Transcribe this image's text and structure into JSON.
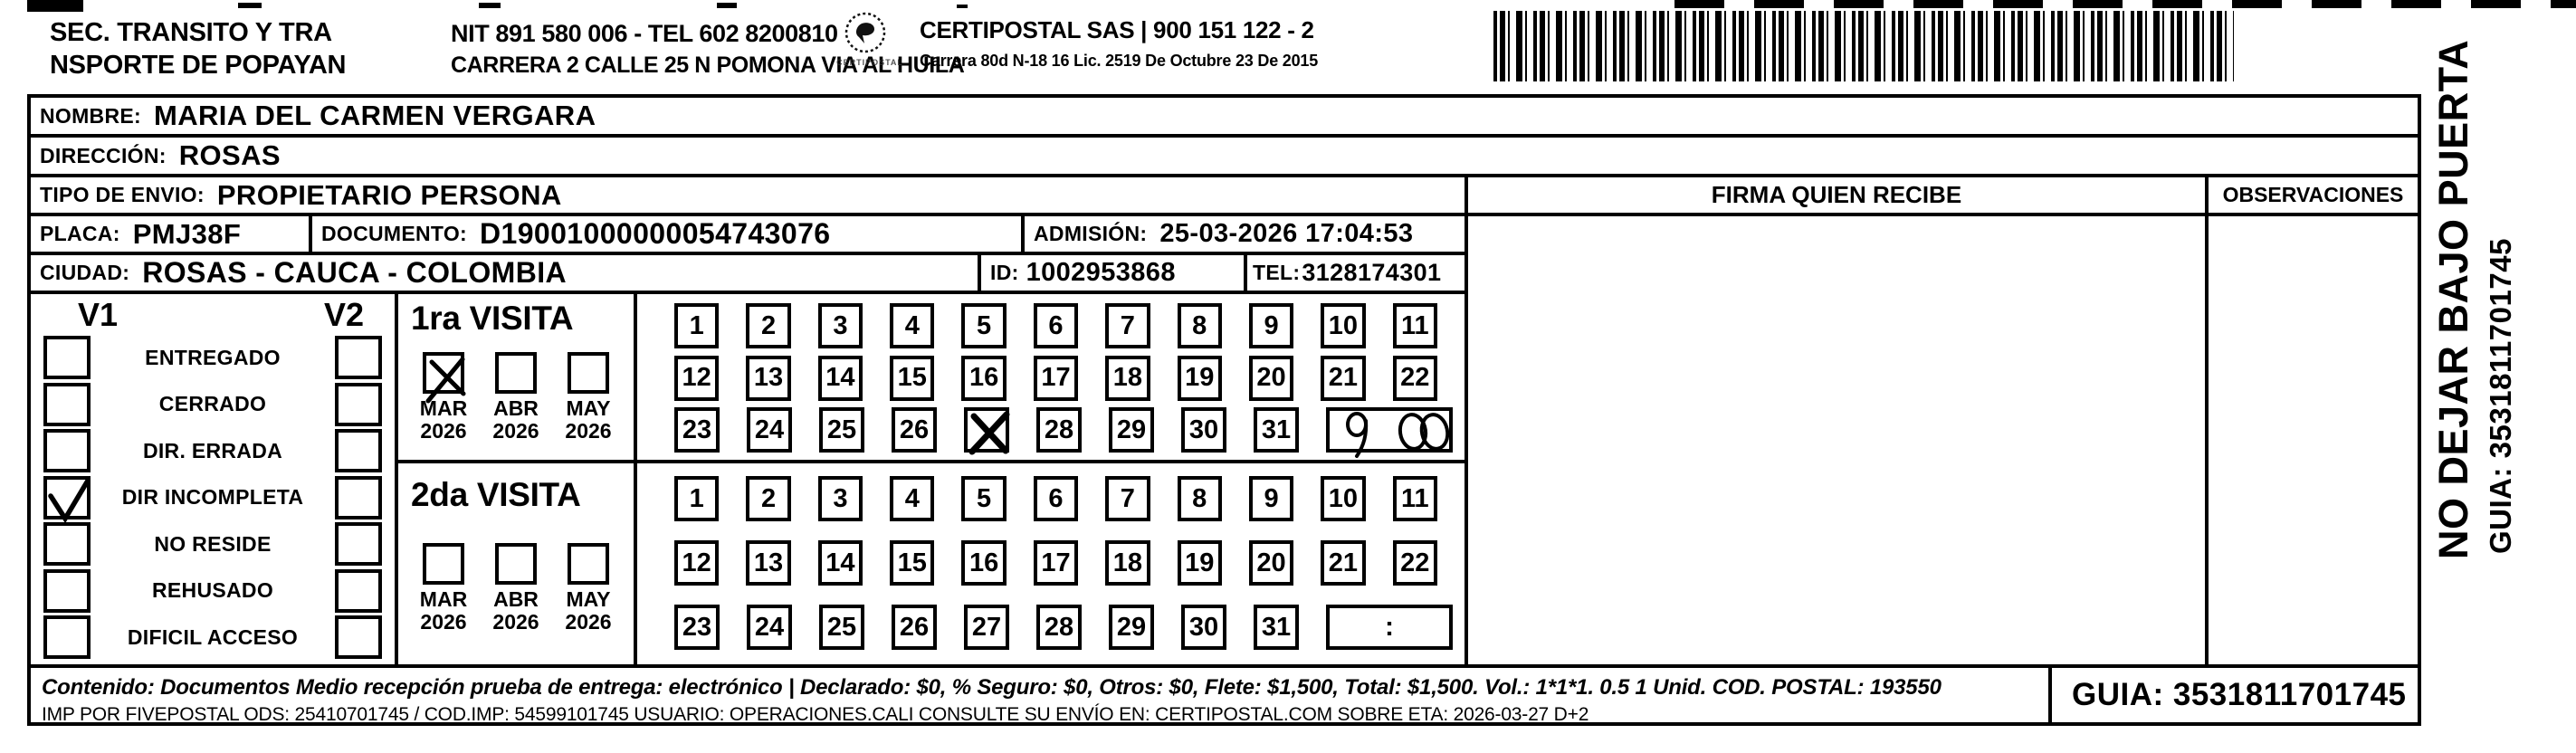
{
  "header": {
    "org_line1": "SEC. TRANSITO Y TRA",
    "org_line2": "NSPORTE DE POPAYAN",
    "nit_line": "NIT 891 580 006 - TEL 602 8200810",
    "address_line": "CARRERA 2 CALLE 25 N POMONA VIA AL HUILA",
    "logo_caption": "CERTIPOSTAL",
    "company_line": "CERTIPOSTAL SAS | 900 151 122 - 2",
    "company_address": "Carrera 80d N-18 16  Lic. 2519 De Octubre 23 De 2015"
  },
  "fields": {
    "nombre_label": "NOMBRE:",
    "nombre": "MARIA DEL CARMEN VERGARA",
    "direccion_label": "DIRECCIÓN:",
    "direccion": "ROSAS",
    "tipo_label": "TIPO DE ENVIO:",
    "tipo": "PROPIETARIO PERSONA",
    "placa_label": "PLACA:",
    "placa": "PMJ38F",
    "documento_label": "DOCUMENTO:",
    "documento": "D19001000000054743076",
    "admision_label": "ADMISIÓN:",
    "admision": "25-03-2026 17:04:53",
    "ciudad_label": "CIUDAD:",
    "ciudad": "ROSAS - CAUCA - COLOMBIA",
    "id_label": "ID:",
    "id": "1002953868",
    "tel_label": "TEL:",
    "tel": "3128174301"
  },
  "status_panel": {
    "col1": "V1",
    "col2": "V2",
    "items": [
      {
        "label": "ENTREGADO",
        "v1": false,
        "v2": false
      },
      {
        "label": "CERRADO",
        "v1": false,
        "v2": false
      },
      {
        "label": "DIR. ERRADA",
        "v1": false,
        "v2": false
      },
      {
        "label": "DIR INCOMPLETA",
        "v1": true,
        "v2": false
      },
      {
        "label": "NO RESIDE",
        "v1": false,
        "v2": false
      },
      {
        "label": "REHUSADO",
        "v1": false,
        "v2": false
      },
      {
        "label": "DIFICIL ACCESO",
        "v1": false,
        "v2": false
      }
    ]
  },
  "visits": {
    "first": {
      "title": "1ra VISITA",
      "months": [
        {
          "month": "MAR",
          "year": "2026",
          "checked": true
        },
        {
          "month": "ABR",
          "year": "2026",
          "checked": false
        },
        {
          "month": "MAY",
          "year": "2026",
          "checked": false
        }
      ],
      "marked_day": 27,
      "time_written": "9:00"
    },
    "second": {
      "title": "2da VISITA",
      "months": [
        {
          "month": "MAR",
          "year": "2026",
          "checked": false
        },
        {
          "month": "ABR",
          "year": "2026",
          "checked": false
        },
        {
          "month": "MAY",
          "year": "2026",
          "checked": false
        }
      ],
      "marked_day": null,
      "time_placeholder": ":"
    }
  },
  "calendar": {
    "days": [
      1,
      2,
      3,
      4,
      5,
      6,
      7,
      8,
      9,
      10,
      11,
      12,
      13,
      14,
      15,
      16,
      17,
      18,
      19,
      20,
      21,
      22,
      23,
      24,
      25,
      26,
      27,
      28,
      29,
      30,
      31
    ]
  },
  "firma_header": "FIRMA QUIEN RECIBE",
  "observaciones_header": "OBSERVACIONES",
  "side": {
    "warning": "NO DEJAR BAJO PUERTA",
    "guia": "GUIA: 3531811701745"
  },
  "footer": {
    "line1": "Contenido: Documentos Medio recepción prueba de entrega: electrónico | Declarado: $0, % Seguro: $0, Otros: $0, Flete: $1,500, Total: $1,500. Vol.: 1*1*1. 0.5  1 Unid. COD. POSTAL: 193550",
    "line2": "IMP POR FIVEPOSTAL ODS: 25410701745 / COD.IMP: 54599101745 USUARIO: OPERACIONES.CALI CONSULTE SU ENVÍO EN: CERTIPOSTAL.COM SOBRE ETA: 2026-03-27 D+2",
    "guia": "GUIA: 3531811701745"
  },
  "colors": {
    "ink": "#000000",
    "paper": "#ffffff"
  }
}
